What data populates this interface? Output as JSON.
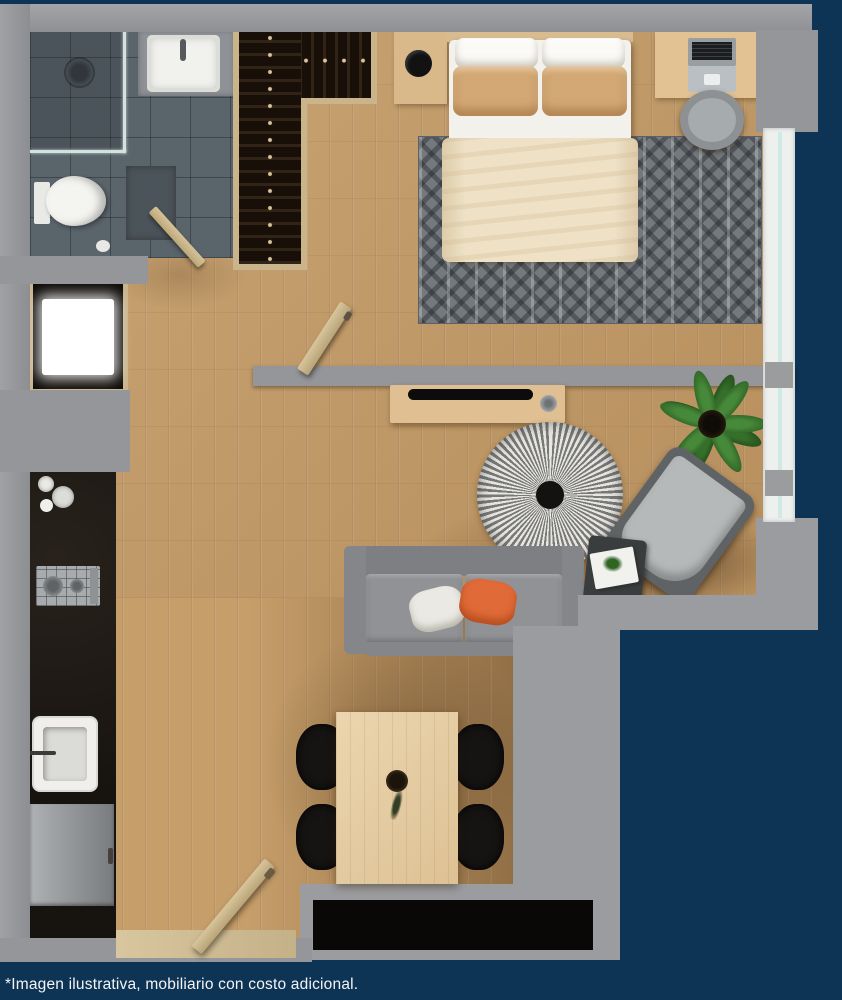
{
  "caption": {
    "text": "*Imagen ilustrativa, mobiliario con costo adicional."
  },
  "palette": {
    "background_navy": "#0d3355",
    "wall_gray": "#95969a",
    "wood_floor": "#c69e6a",
    "bathroom_tile": "#5a646b",
    "kitchen_counter_black": "#17130f",
    "wood_trim": "#c9b48c",
    "duvet_cream": "#eee1c5",
    "pillow_tan": "#d3a874",
    "pillow_orange": "#e06b38",
    "sofa_gray": "#84868a",
    "plant_green": "#3a7a2c",
    "window_white": "#eef0ee"
  },
  "floor_plan": {
    "type": "studio-apartment-top-down-render",
    "rooms": [
      {
        "name": "bathroom",
        "items": [
          "shower",
          "glass-partition",
          "shower-head",
          "vanity-sink",
          "toilet",
          "bath-mat",
          "bathroom-door"
        ]
      },
      {
        "name": "closet",
        "items": [
          "hanging-clothes-rail-top",
          "hanging-clothes-rail-side"
        ]
      },
      {
        "name": "bedroom",
        "items": [
          "double-bed",
          "white-pillows",
          "tan-pillows",
          "cream-duvet",
          "patterned-rug",
          "nightstand",
          "round-tray",
          "desk",
          "laptop",
          "desk-chair",
          "sliding-door"
        ]
      },
      {
        "name": "living-room",
        "items": [
          "tv-console",
          "tv",
          "speaker",
          "round-striped-rug",
          "sofa",
          "white-cushion",
          "orange-cushion",
          "lounge-armchair",
          "side-table",
          "magazines",
          "potted-plant"
        ]
      },
      {
        "name": "kitchen",
        "items": [
          "black-counter",
          "dishes",
          "two-burner-stove",
          "sink",
          "refrigerator",
          "washer"
        ]
      },
      {
        "name": "dining",
        "items": [
          "wood-table",
          "black-chair-1",
          "black-chair-2",
          "black-chair-3",
          "black-chair-4",
          "vase-centerpiece"
        ]
      },
      {
        "name": "entry",
        "items": [
          "entry-door",
          "threshold"
        ]
      }
    ],
    "openings": [
      "window-right",
      "entry-bottom-left"
    ]
  }
}
